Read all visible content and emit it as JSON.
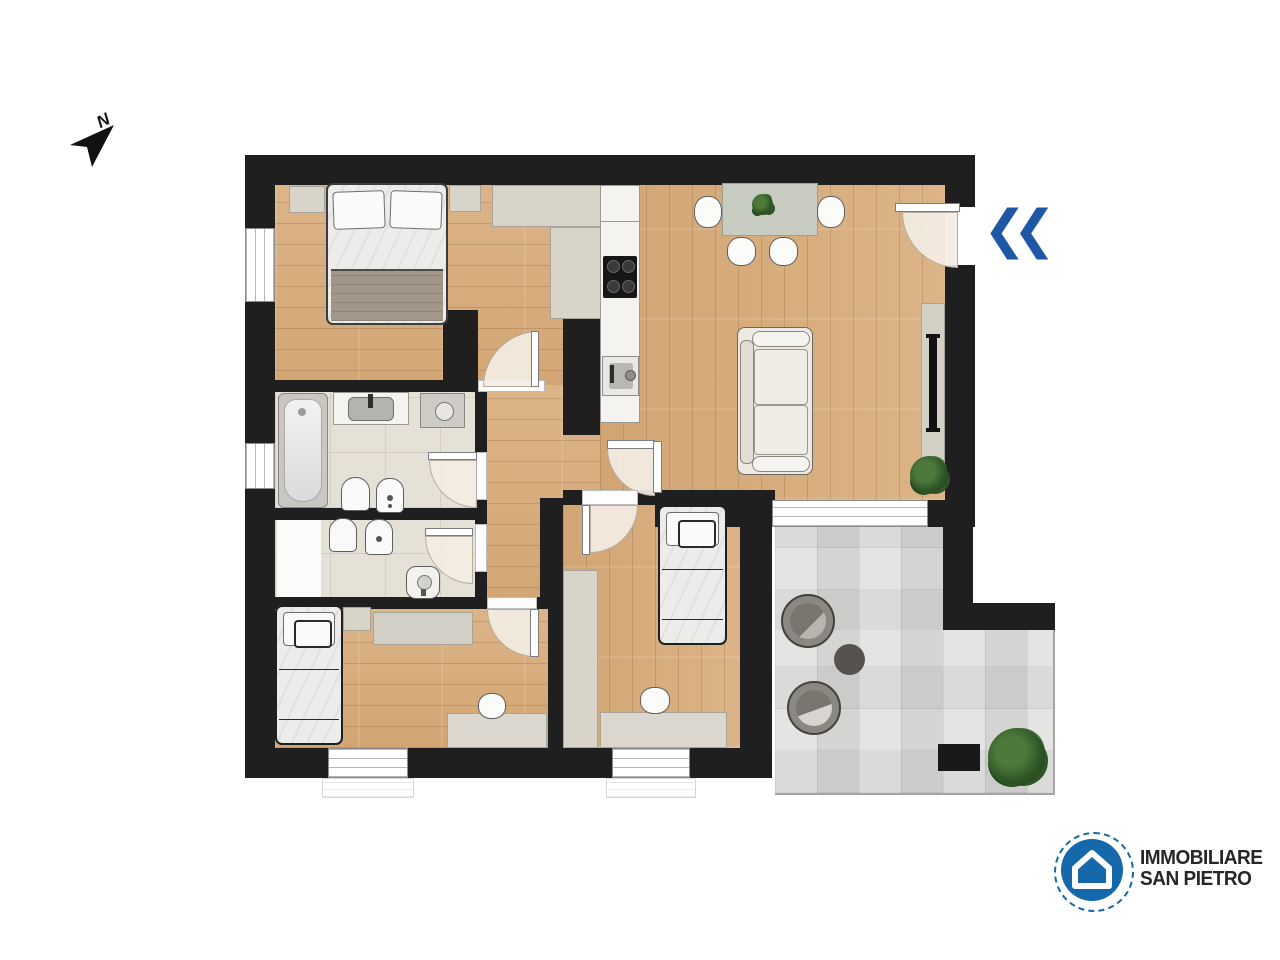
{
  "page": {
    "width": 1280,
    "height": 960,
    "background": "#ffffff",
    "type": "real-estate floor plan"
  },
  "compass": {
    "label": "N",
    "direction": "north pointing upper-right"
  },
  "entrance_marker": {
    "icon": "double-left-chevron-icon",
    "color": "#1d57a5",
    "meaning": "entrance direction into apartment"
  },
  "branding": {
    "line1": "IMMOBILIARE",
    "line2": "SAN PIETRO",
    "logo_icon": "house-in-circle-icon",
    "logo_color": "#1568a9",
    "text_color": "#262626"
  },
  "palette": {
    "wall": "#1f1f1f",
    "wood_floor": "#d7ac7c",
    "bathroom_tile": "#e6e1d7",
    "terrace_tile": "#dbdbd9",
    "furniture_beige": "#d8d4ca",
    "door_swing": "#f3ede4",
    "accent_blue": "#1d57a5"
  },
  "rooms": [
    {
      "name": "bedroom-main",
      "position": "top-left",
      "floor": "wood",
      "furniture": [
        "double-bed",
        "nightstand-left",
        "nightstand-right",
        "corner-wardrobe"
      ],
      "windows": 1
    },
    {
      "name": "living-kitchen",
      "position": "top-right",
      "floor": "wood",
      "furniture": [
        "kitchen-counter",
        "cooktop",
        "sink",
        "dining-table",
        "4-chairs",
        "table-plant",
        "sofa",
        "tv-sideboard",
        "tv",
        "floor-plant"
      ],
      "windows": 1,
      "doors": [
        "entry-door"
      ]
    },
    {
      "name": "bathroom-1",
      "position": "middle-left",
      "floor": "tile",
      "furniture": [
        "bathtub",
        "vanity-sink",
        "washing-machine",
        "toilet",
        "bidet"
      ],
      "windows": 1
    },
    {
      "name": "bathroom-2",
      "position": "middle-left-lower",
      "floor": "tile",
      "furniture": [
        "toilet",
        "bidet",
        "shower"
      ],
      "windows": 0
    },
    {
      "name": "hallway",
      "position": "center",
      "floor": "wood",
      "furniture": [],
      "windows": 0
    },
    {
      "name": "bedroom-2",
      "position": "bottom-left",
      "floor": "wood",
      "furniture": [
        "single-bed",
        "nightstand",
        "dresser",
        "desk",
        "desk-chair"
      ],
      "windows": 1
    },
    {
      "name": "bedroom-3",
      "position": "bottom-center",
      "floor": "wood",
      "furniture": [
        "single-bed",
        "wardrobe",
        "desk",
        "desk-chair"
      ],
      "windows": 1
    },
    {
      "name": "terrace",
      "position": "bottom-right",
      "floor": "outdoor-tile",
      "furniture": [
        "round-lounge-chair-1",
        "round-lounge-chair-2",
        "round-side-table",
        "storage-box",
        "potted-plant"
      ],
      "windows": 0
    }
  ]
}
